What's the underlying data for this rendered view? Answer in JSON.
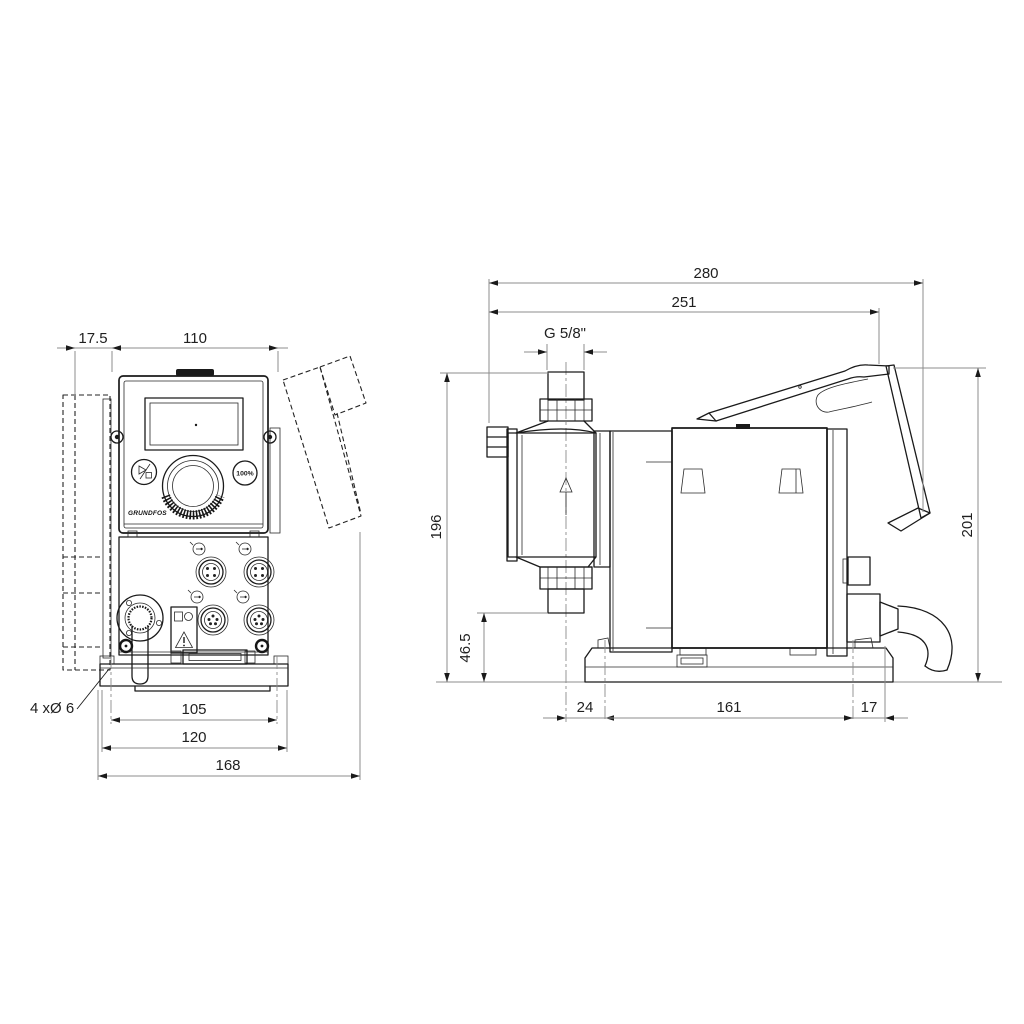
{
  "colors": {
    "line": "#1a1a1a",
    "dimension": "#8c8c8c",
    "background": "#ffffff"
  },
  "icons": {
    "start_stop_button": "play-stop-symbol",
    "flow_direction": "up-arrow",
    "warning": "warning-triangle",
    "logo": "grundfos-logo",
    "sockets": "m12-connector"
  },
  "front_view": {
    "dimensions": {
      "bracket_offset": "17.5",
      "housing_width": "110",
      "mounting_hole_spacing": "105",
      "base_width": "120",
      "overall_width": "168"
    },
    "mounting_holes_note": "4 xØ 6",
    "control_panel": {
      "hundred_percent_button": "100%",
      "logo_text": "GRUNDFOS"
    }
  },
  "side_view": {
    "dimensions": {
      "overall_depth": "280",
      "depth_to_cover": "251",
      "connection_thread": "G 5/8\"",
      "height_to_connection": "196",
      "connection_height": "46.5",
      "overall_height": "201",
      "front_overhang": "24",
      "mounting_hole_spacing": "161",
      "rear_offset": "17"
    }
  }
}
